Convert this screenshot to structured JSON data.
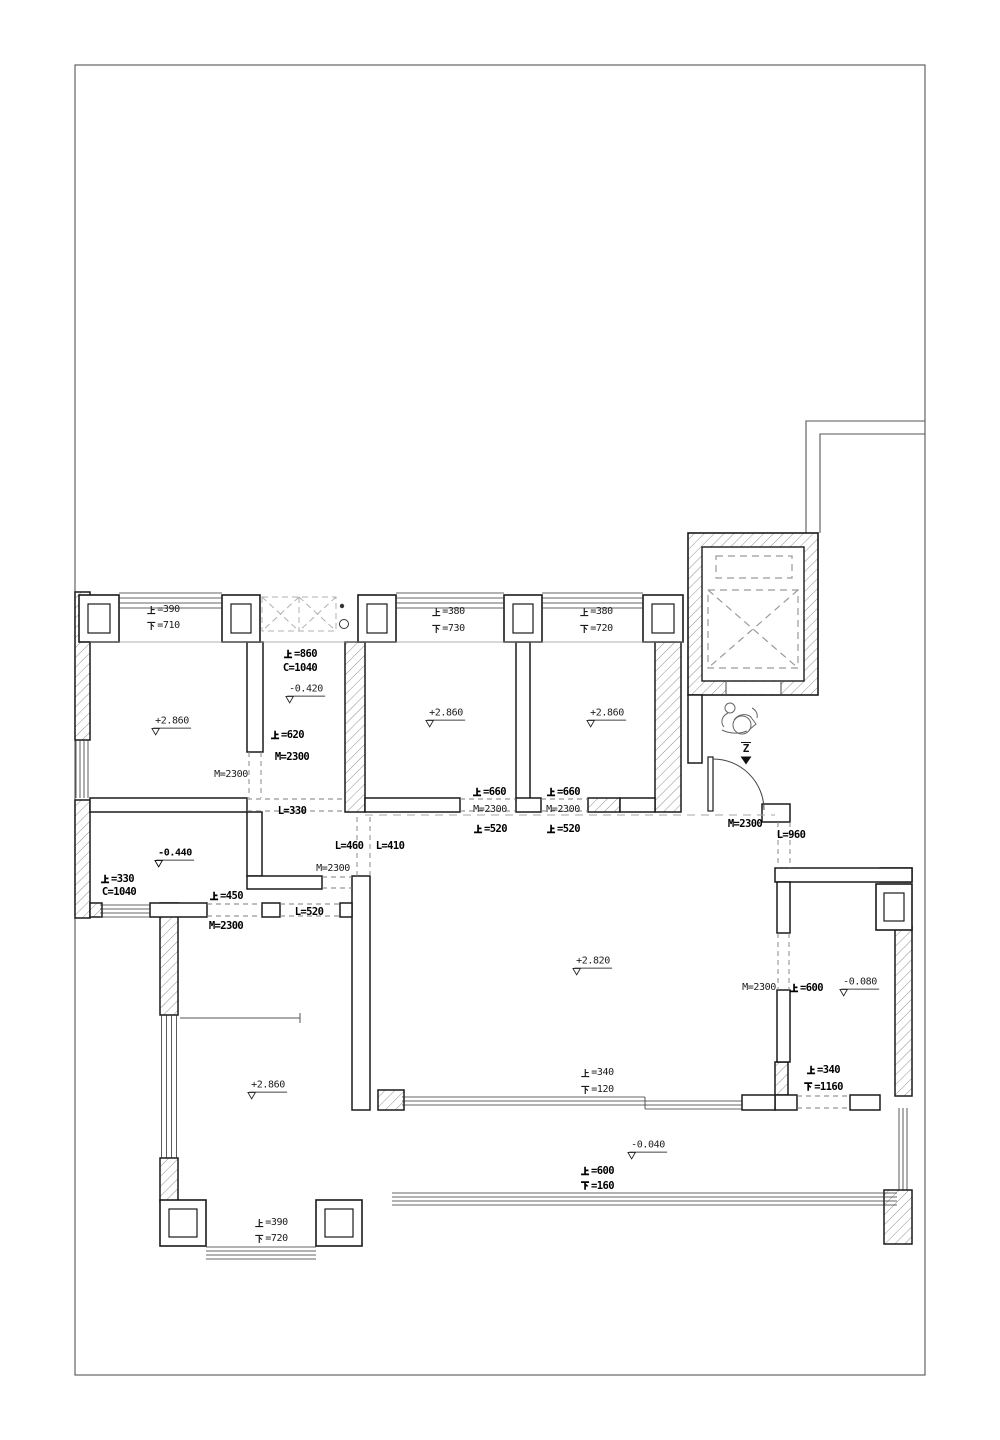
{
  "drawing": {
    "type": "floor-plan",
    "entry_mark": {
      "t": "Z",
      "x": 745,
      "y": 751
    },
    "labels": [
      {
        "t": "上=390",
        "x": 163,
        "y": 610,
        "s": "r"
      },
      {
        "t": "下=710",
        "x": 163,
        "y": 626,
        "s": "r"
      },
      {
        "t": "上=380",
        "x": 448,
        "y": 612,
        "s": "r"
      },
      {
        "t": "下=730",
        "x": 448,
        "y": 629,
        "s": "r"
      },
      {
        "t": "上=380",
        "x": 596,
        "y": 612,
        "s": "r"
      },
      {
        "t": "下=720",
        "x": 596,
        "y": 629,
        "s": "r"
      },
      {
        "t": "上=860",
        "x": 300,
        "y": 654,
        "s": "b"
      },
      {
        "t": "C=1040",
        "x": 300,
        "y": 668,
        "s": "b"
      },
      {
        "t": "上=620",
        "x": 287,
        "y": 735,
        "s": "b"
      },
      {
        "t": "M=2300",
        "x": 292,
        "y": 757,
        "s": "b"
      },
      {
        "t": "M=2300",
        "x": 231,
        "y": 775,
        "s": "r"
      },
      {
        "t": "L=330",
        "x": 292,
        "y": 811,
        "s": "b"
      },
      {
        "t": "上=660",
        "x": 489,
        "y": 792,
        "s": "b"
      },
      {
        "t": "M=2300",
        "x": 490,
        "y": 810,
        "s": "r"
      },
      {
        "t": "上=520",
        "x": 490,
        "y": 829,
        "s": "b"
      },
      {
        "t": "上=660",
        "x": 563,
        "y": 792,
        "s": "b"
      },
      {
        "t": "M=2300",
        "x": 563,
        "y": 810,
        "s": "r"
      },
      {
        "t": "上=520",
        "x": 563,
        "y": 829,
        "s": "b"
      },
      {
        "t": "L=460",
        "x": 349,
        "y": 846,
        "s": "b"
      },
      {
        "t": "L=410",
        "x": 390,
        "y": 846,
        "s": "b"
      },
      {
        "t": "M=2300",
        "x": 333,
        "y": 869,
        "s": "r"
      },
      {
        "t": "上=330",
        "x": 117,
        "y": 879,
        "s": "b"
      },
      {
        "t": "C=1040",
        "x": 119,
        "y": 892,
        "s": "b"
      },
      {
        "t": "上=450",
        "x": 226,
        "y": 896,
        "s": "b"
      },
      {
        "t": "L=520",
        "x": 309,
        "y": 912,
        "s": "b"
      },
      {
        "t": "M=2300",
        "x": 226,
        "y": 926,
        "s": "b"
      },
      {
        "t": "M=2300",
        "x": 745,
        "y": 824,
        "s": "b"
      },
      {
        "t": "L=960",
        "x": 791,
        "y": 835,
        "s": "b"
      },
      {
        "t": "M=2300",
        "x": 759,
        "y": 988,
        "s": "r"
      },
      {
        "t": "上=600",
        "x": 806,
        "y": 988,
        "s": "b"
      },
      {
        "t": "上=340",
        "x": 823,
        "y": 1070,
        "s": "b"
      },
      {
        "t": "下=1160",
        "x": 823,
        "y": 1087,
        "s": "b"
      },
      {
        "t": "上=340",
        "x": 597,
        "y": 1073,
        "s": "r"
      },
      {
        "t": "下=120",
        "x": 597,
        "y": 1090,
        "s": "r"
      },
      {
        "t": "上=600",
        "x": 597,
        "y": 1171,
        "s": "b"
      },
      {
        "t": "下=160",
        "x": 597,
        "y": 1186,
        "s": "b"
      },
      {
        "t": "上=390",
        "x": 271,
        "y": 1223,
        "s": "r"
      },
      {
        "t": "下=720",
        "x": 271,
        "y": 1239,
        "s": "r"
      }
    ],
    "elevations": [
      {
        "t": "+2.860",
        "x": 169,
        "y": 725,
        "s": "r"
      },
      {
        "t": "+2.860",
        "x": 443,
        "y": 717,
        "s": "r"
      },
      {
        "t": "+2.860",
        "x": 604,
        "y": 717,
        "s": "r"
      },
      {
        "t": "-0.420",
        "x": 303,
        "y": 693,
        "s": "r"
      },
      {
        "t": "-0.440",
        "x": 172,
        "y": 857,
        "s": "b"
      },
      {
        "t": "+2.820",
        "x": 590,
        "y": 965,
        "s": "r"
      },
      {
        "t": "-0.080",
        "x": 857,
        "y": 986,
        "s": "r"
      },
      {
        "t": "+2.860",
        "x": 265,
        "y": 1089,
        "s": "r"
      },
      {
        "t": "-0.040",
        "x": 645,
        "y": 1149,
        "s": "r"
      }
    ]
  },
  "colors": {
    "wall": "#1a1a1a",
    "thin": "#555555",
    "dash": "#888888",
    "hatch": "#909090",
    "bg": "#ffffff"
  }
}
